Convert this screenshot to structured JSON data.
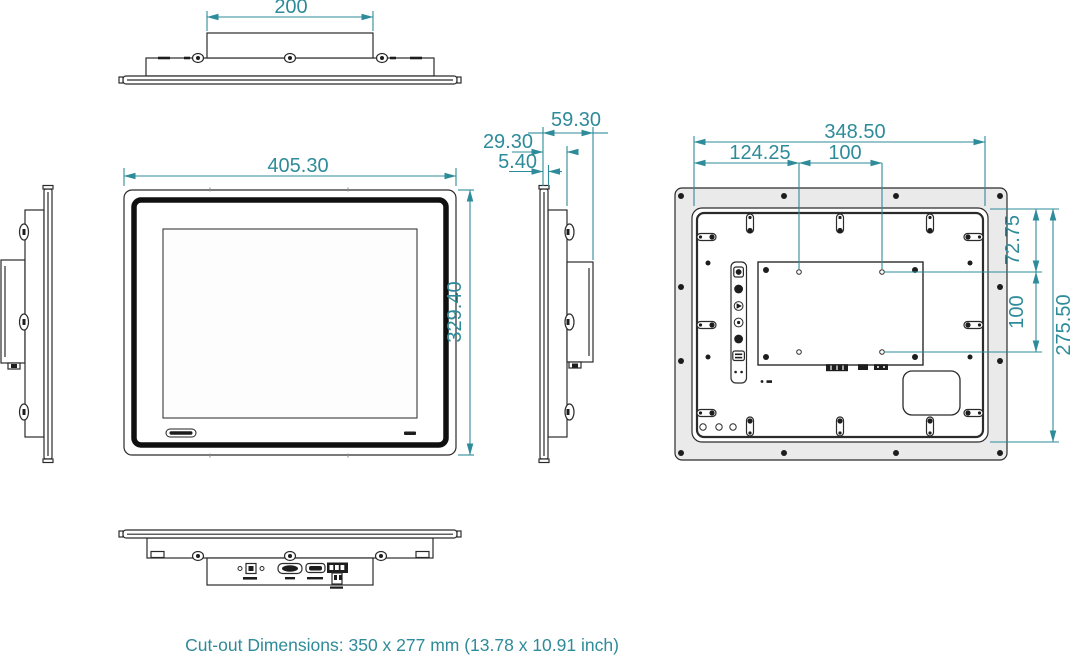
{
  "drawing": {
    "type": "technical-drawing",
    "views": {
      "top": {
        "dims": {
          "mount_width": "200"
        }
      },
      "front": {
        "dims": {
          "width": "405.30",
          "height": "329.40"
        }
      },
      "side": {
        "dims": {
          "total_depth": "59.30",
          "body_depth": "29.30",
          "bezel_thickness": "5.40"
        }
      },
      "rear": {
        "dims": {
          "body_width": "348.50",
          "vesa_offset_x": "124.25",
          "vesa_pitch_x": "100",
          "vesa_offset_y": "72.75",
          "vesa_pitch_y": "100",
          "body_height": "275.50"
        }
      }
    },
    "footer": {
      "cutout_note": "Cut-out Dimensions: 350 x 277 mm (13.78 x 10.91 inch)"
    },
    "colors": {
      "dimension_accent": "#2e8b99",
      "line": "#2b2b2b",
      "flange_fill": "#eaeaea",
      "connector_dark": "#1d1d1d"
    }
  }
}
